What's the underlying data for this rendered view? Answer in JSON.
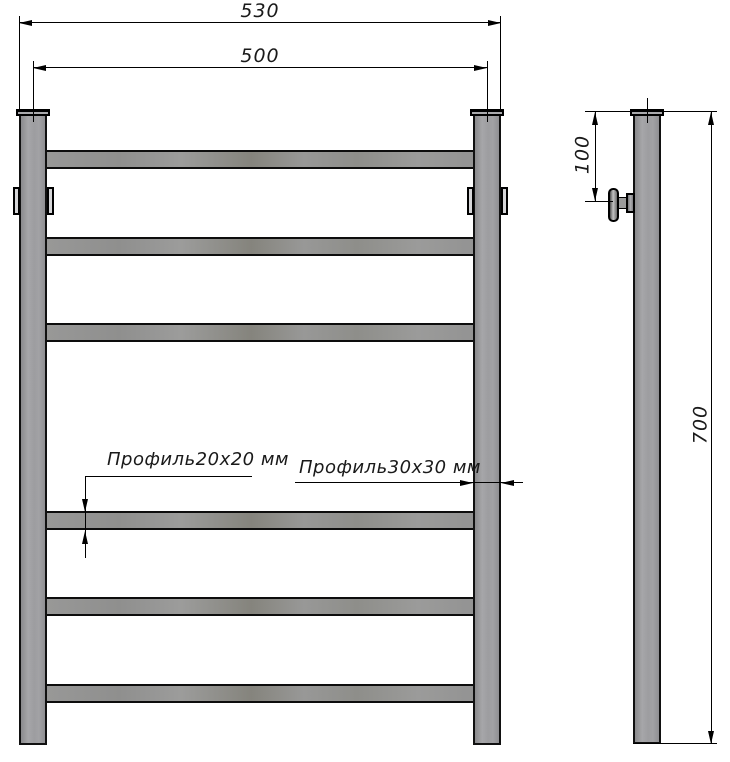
{
  "drawing": {
    "type": "technical-drawing",
    "views": [
      "front",
      "side"
    ],
    "crossbar_count": 6,
    "post_count": 2
  },
  "front_view": {
    "dim_overall_width": "530",
    "dim_center_width": "500",
    "label_crossbar_profile": "Профиль20х20 мм",
    "label_post_profile": "Профиль30х30 мм"
  },
  "side_view": {
    "dim_bracket_offset": "100",
    "dim_overall_height": "700"
  },
  "colors": {
    "background": "#ffffff",
    "metal_fill": "#9a9a9d",
    "outline": "#000000",
    "dimension_lines": "#000000"
  }
}
